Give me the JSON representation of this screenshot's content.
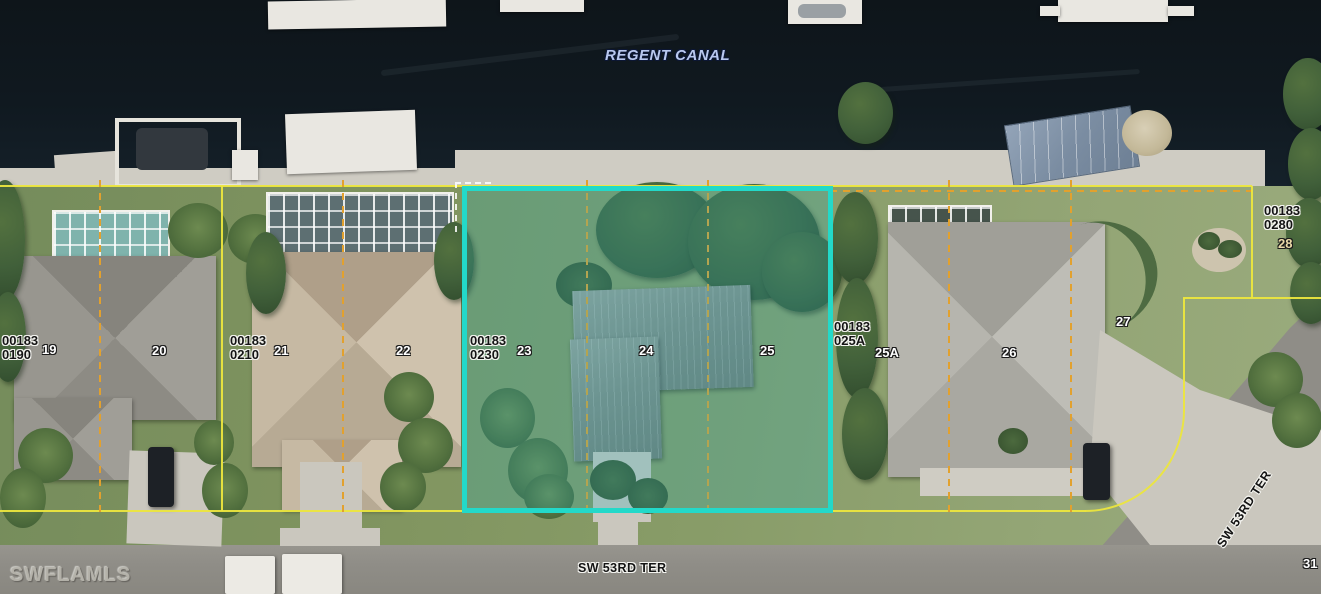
{
  "map": {
    "canal_label": "REGENT CANAL",
    "watermark": "SWFLAMLS",
    "streets": {
      "bottom": "SW 53RD TER",
      "right": "SW 53RD TER"
    },
    "partial_lot_number": "31",
    "parcels": [
      {
        "line1": "00183",
        "line2": "0190"
      },
      {
        "line1": "00183",
        "line2": "0210"
      },
      {
        "line1": "00183",
        "line2": "0230"
      },
      {
        "line1": "00183",
        "line2": "025A"
      },
      {
        "line1": "00183",
        "line2": "0280"
      }
    ],
    "lot_numbers": [
      "19",
      "20",
      "21",
      "22",
      "23",
      "24",
      "25",
      "25A",
      "26",
      "27",
      "28"
    ],
    "colors": {
      "highlight_border": "#23d9c9",
      "highlight_fill": "rgba(32,175,190,0.24)",
      "boundary_solid_yellow": "#ece63e",
      "boundary_dashed_orange": "#e2a12e",
      "water": "#101920",
      "grass": "#80945f",
      "road": "#8f8d87",
      "concrete": "#cfccc3",
      "canal_text": "#b9c8ee"
    }
  }
}
